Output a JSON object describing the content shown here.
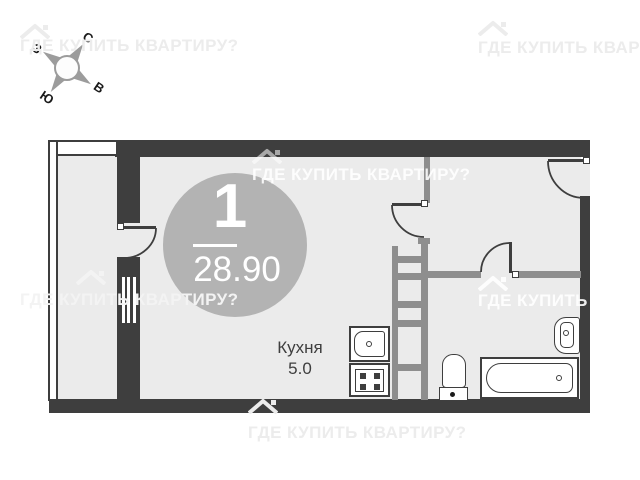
{
  "watermark": {
    "text": "ГДЕ КУПИТЬ КВАРТИРУ?"
  },
  "compass": {
    "north": "С",
    "east": "В",
    "south": "Ю",
    "west": "З"
  },
  "unit_badge": {
    "rooms": "1",
    "area_m2": "28.90"
  },
  "labels": {
    "kitchen_name": "Кухня",
    "kitchen_area": "5.0"
  },
  "colors": {
    "wall": "#3e3e3e",
    "partition": "#8e8e8e",
    "floor": "#ebebeb",
    "badge": "#b3b3b3",
    "watermark": "#ececec"
  }
}
